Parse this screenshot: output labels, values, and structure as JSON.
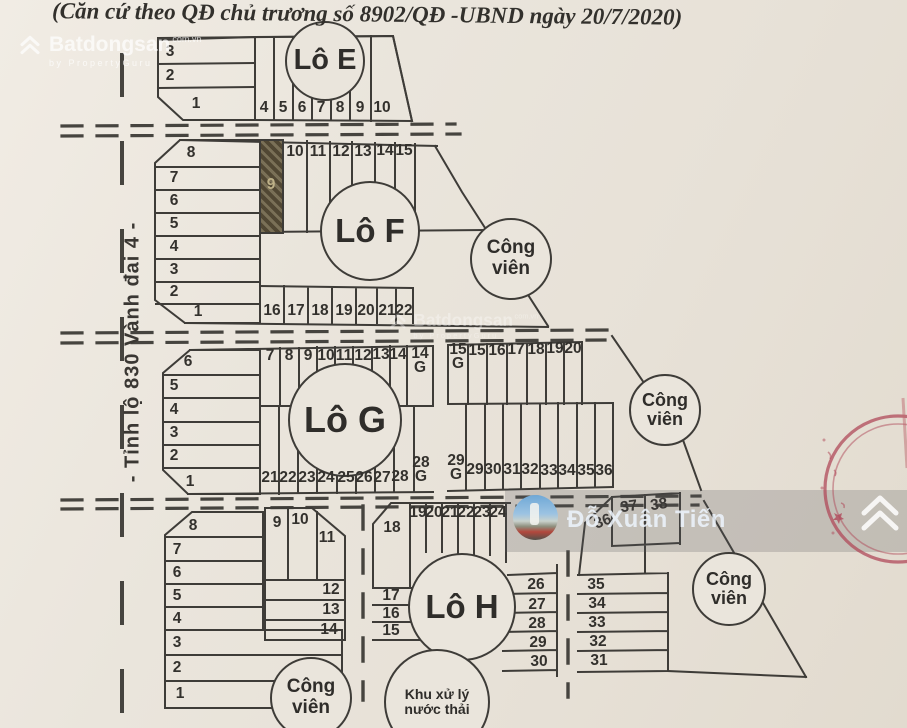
{
  "header": {
    "title": "(Căn cứ theo QĐ chủ trương số 8902/QĐ -UBND ngày 20/7/2020)"
  },
  "road": {
    "label": "- Tỉnh lộ 830 Vành đai 4 -"
  },
  "brand": {
    "name": "Batdongsan",
    "suffix": "com.vn",
    "tagline": "by PropertyGuru",
    "icon": "double-chevron-roof-icon"
  },
  "user_watermark": {
    "name": "Đỗ Xuân Tiến"
  },
  "colors": {
    "line": "#3e3c38",
    "paper": "#e9e4db",
    "stamp_red": "#b0495a",
    "hatch_dark": "#514733",
    "hatch_light": "#7a7057",
    "watermark_band": "rgba(88,88,92,0.23)"
  },
  "circles": [
    {
      "id": "block-e",
      "lines": [
        "Lô E"
      ],
      "x": 325,
      "y": 61,
      "r": 40,
      "fs": 29
    },
    {
      "id": "block-f",
      "lines": [
        "Lô F"
      ],
      "x": 370,
      "y": 231,
      "r": 50,
      "fs": 33
    },
    {
      "id": "block-g",
      "lines": [
        "Lô G"
      ],
      "x": 345,
      "y": 420,
      "r": 57,
      "fs": 36
    },
    {
      "id": "block-h",
      "lines": [
        "Lô H"
      ],
      "x": 462,
      "y": 607,
      "r": 54,
      "fs": 33
    },
    {
      "id": "park-f",
      "lines": [
        "Công",
        "viên"
      ],
      "x": 511,
      "y": 259,
      "r": 41,
      "fs": 19
    },
    {
      "id": "park-g",
      "lines": [
        "Công",
        "viên"
      ],
      "x": 665,
      "y": 410,
      "r": 36,
      "fs": 18
    },
    {
      "id": "park-h",
      "lines": [
        "Công",
        "viên"
      ],
      "x": 729,
      "y": 589,
      "r": 37,
      "fs": 18
    },
    {
      "id": "park-south",
      "lines": [
        "Công",
        "viên"
      ],
      "x": 311,
      "y": 698,
      "r": 41,
      "fs": 19
    },
    {
      "id": "waste-treatment",
      "lines": [
        "Khu xử lý",
        "nước thải"
      ],
      "x": 437,
      "y": 702,
      "r": 53,
      "fs": 14
    }
  ],
  "lots": [
    {
      "n": "3",
      "x": 170,
      "y": 52
    },
    {
      "n": "2",
      "x": 170,
      "y": 76
    },
    {
      "n": "1",
      "x": 196,
      "y": 104
    },
    {
      "n": "4",
      "x": 264,
      "y": 108
    },
    {
      "n": "5",
      "x": 283,
      "y": 108
    },
    {
      "n": "6",
      "x": 302,
      "y": 108
    },
    {
      "n": "7",
      "x": 321,
      "y": 108
    },
    {
      "n": "8",
      "x": 340,
      "y": 108
    },
    {
      "n": "9",
      "x": 360,
      "y": 108
    },
    {
      "n": "10",
      "x": 382,
      "y": 108
    },
    {
      "n": "8",
      "x": 191,
      "y": 153
    },
    {
      "n": "7",
      "x": 174,
      "y": 178
    },
    {
      "n": "6",
      "x": 174,
      "y": 201
    },
    {
      "n": "5",
      "x": 174,
      "y": 224
    },
    {
      "n": "4",
      "x": 174,
      "y": 247
    },
    {
      "n": "3",
      "x": 174,
      "y": 270
    },
    {
      "n": "2",
      "x": 174,
      "y": 292
    },
    {
      "n": "1",
      "x": 198,
      "y": 312
    },
    {
      "n": "9",
      "x": 271,
      "y": 185,
      "cls": "hatch-label"
    },
    {
      "n": "10",
      "x": 295,
      "y": 152
    },
    {
      "n": "11",
      "x": 318,
      "y": 152
    },
    {
      "n": "12",
      "x": 341,
      "y": 152
    },
    {
      "n": "13",
      "x": 363,
      "y": 152
    },
    {
      "n": "14",
      "x": 385,
      "y": 151
    },
    {
      "n": "15",
      "x": 404,
      "y": 151
    },
    {
      "n": "16",
      "x": 272,
      "y": 311
    },
    {
      "n": "17",
      "x": 296,
      "y": 311
    },
    {
      "n": "18",
      "x": 320,
      "y": 311
    },
    {
      "n": "19",
      "x": 344,
      "y": 311
    },
    {
      "n": "20",
      "x": 366,
      "y": 311
    },
    {
      "n": "21",
      "x": 387,
      "y": 311
    },
    {
      "n": "22",
      "x": 404,
      "y": 311
    },
    {
      "n": "6",
      "x": 188,
      "y": 362
    },
    {
      "n": "5",
      "x": 174,
      "y": 386
    },
    {
      "n": "4",
      "x": 174,
      "y": 410
    },
    {
      "n": "3",
      "x": 174,
      "y": 433
    },
    {
      "n": "2",
      "x": 174,
      "y": 456
    },
    {
      "n": "1",
      "x": 190,
      "y": 482
    },
    {
      "n": "7",
      "x": 270,
      "y": 356
    },
    {
      "n": "8",
      "x": 289,
      "y": 356
    },
    {
      "n": "9",
      "x": 308,
      "y": 356
    },
    {
      "n": "10",
      "x": 326,
      "y": 356
    },
    {
      "n": "11",
      "x": 344,
      "y": 356
    },
    {
      "n": "12",
      "x": 363,
      "y": 356
    },
    {
      "n": "13",
      "x": 381,
      "y": 355
    },
    {
      "n": "14",
      "x": 398,
      "y": 355
    },
    {
      "n": "14\nG",
      "x": 420,
      "y": 361
    },
    {
      "n": "15\nG",
      "x": 458,
      "y": 357
    },
    {
      "n": "15",
      "x": 477,
      "y": 351
    },
    {
      "n": "16",
      "x": 497,
      "y": 351
    },
    {
      "n": "17",
      "x": 516,
      "y": 350
    },
    {
      "n": "18",
      "x": 536,
      "y": 350
    },
    {
      "n": "19",
      "x": 555,
      "y": 349
    },
    {
      "n": "20",
      "x": 573,
      "y": 349
    },
    {
      "n": "21",
      "x": 270,
      "y": 478
    },
    {
      "n": "22",
      "x": 288,
      "y": 478
    },
    {
      "n": "23",
      "x": 307,
      "y": 478
    },
    {
      "n": "24",
      "x": 326,
      "y": 478
    },
    {
      "n": "25",
      "x": 346,
      "y": 478
    },
    {
      "n": "26",
      "x": 364,
      "y": 478
    },
    {
      "n": "27",
      "x": 382,
      "y": 478
    },
    {
      "n": "28",
      "x": 400,
      "y": 477
    },
    {
      "n": "28\nG",
      "x": 421,
      "y": 470
    },
    {
      "n": "29\nG",
      "x": 456,
      "y": 468
    },
    {
      "n": "29",
      "x": 475,
      "y": 470
    },
    {
      "n": "30",
      "x": 493,
      "y": 470
    },
    {
      "n": "31",
      "x": 512,
      "y": 470
    },
    {
      "n": "32",
      "x": 530,
      "y": 470
    },
    {
      "n": "33",
      "x": 549,
      "y": 471
    },
    {
      "n": "34",
      "x": 567,
      "y": 471
    },
    {
      "n": "35",
      "x": 586,
      "y": 471
    },
    {
      "n": "36",
      "x": 604,
      "y": 471
    },
    {
      "n": "8",
      "x": 193,
      "y": 526
    },
    {
      "n": "7",
      "x": 177,
      "y": 550
    },
    {
      "n": "6",
      "x": 177,
      "y": 573
    },
    {
      "n": "5",
      "x": 177,
      "y": 596
    },
    {
      "n": "4",
      "x": 177,
      "y": 619
    },
    {
      "n": "3",
      "x": 177,
      "y": 643
    },
    {
      "n": "2",
      "x": 177,
      "y": 668
    },
    {
      "n": "1",
      "x": 180,
      "y": 694
    },
    {
      "n": "9",
      "x": 277,
      "y": 523
    },
    {
      "n": "10",
      "x": 300,
      "y": 520
    },
    {
      "n": "11",
      "x": 327,
      "y": 538
    },
    {
      "n": "12",
      "x": 331,
      "y": 590
    },
    {
      "n": "13",
      "x": 331,
      "y": 610
    },
    {
      "n": "14",
      "x": 329,
      "y": 630
    },
    {
      "n": "18",
      "x": 392,
      "y": 528
    },
    {
      "n": "17",
      "x": 391,
      "y": 596
    },
    {
      "n": "16",
      "x": 391,
      "y": 614
    },
    {
      "n": "15",
      "x": 391,
      "y": 631
    },
    {
      "n": "19",
      "x": 418,
      "y": 513
    },
    {
      "n": "20",
      "x": 434,
      "y": 513
    },
    {
      "n": "21",
      "x": 450,
      "y": 513
    },
    {
      "n": "22",
      "x": 466,
      "y": 513
    },
    {
      "n": "23",
      "x": 482,
      "y": 513
    },
    {
      "n": "24",
      "x": 498,
      "y": 513
    },
    {
      "n": "26",
      "x": 536,
      "y": 585
    },
    {
      "n": "27",
      "x": 537,
      "y": 605
    },
    {
      "n": "28",
      "x": 537,
      "y": 624
    },
    {
      "n": "29",
      "x": 538,
      "y": 643
    },
    {
      "n": "30",
      "x": 539,
      "y": 662
    },
    {
      "n": "37",
      "x": 629,
      "y": 507,
      "rot": -8
    },
    {
      "n": "38",
      "x": 659,
      "y": 505,
      "rot": -8
    },
    {
      "n": "36",
      "x": 603,
      "y": 522,
      "rot": -20
    },
    {
      "n": "35",
      "x": 596,
      "y": 585
    },
    {
      "n": "34",
      "x": 597,
      "y": 604
    },
    {
      "n": "33",
      "x": 597,
      "y": 623
    },
    {
      "n": "32",
      "x": 598,
      "y": 642
    },
    {
      "n": "31",
      "x": 599,
      "y": 661
    }
  ]
}
